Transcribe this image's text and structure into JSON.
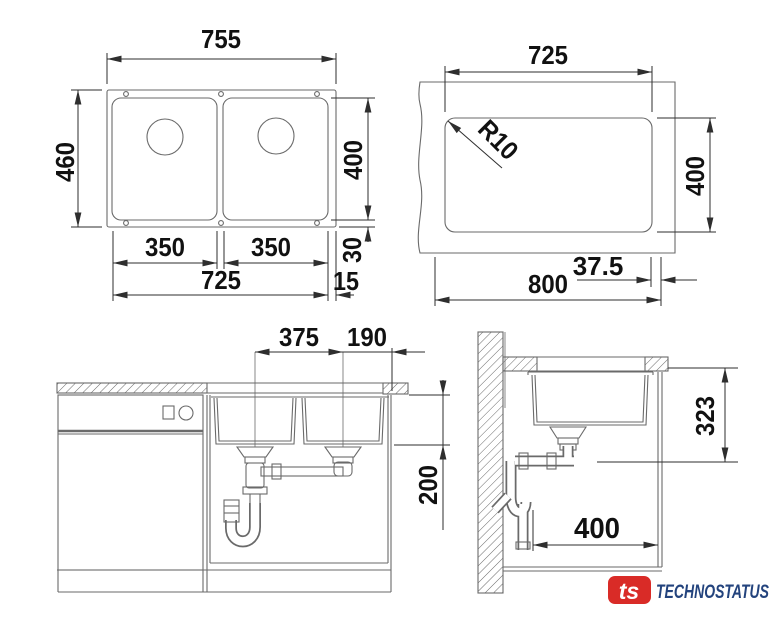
{
  "drawing": {
    "plan": {
      "overall_width": "755",
      "overall_depth": "460",
      "bowl_depth": "400",
      "rear_gap": "30",
      "side_gap": "15",
      "bowl_width_left": "350",
      "bowl_width_right": "350",
      "bowls_span": "725"
    },
    "cutout": {
      "cutout_width": "725",
      "corner_radius": "R10",
      "cutout_depth": "400",
      "edge_margin": "37.5",
      "min_width": "800"
    },
    "front_section": {
      "drain_spacing": "375",
      "drain_to_edge": "190",
      "depth_below_top": "200"
    },
    "side_section": {
      "installation_depth": "323",
      "drain_offset": "400"
    }
  },
  "branding": {
    "logo_monogram": "ts",
    "brand_name": "TECHNOSTATUS",
    "logo_bg_color": "#d92b27",
    "brand_text_color": "#23437d"
  },
  "colors": {
    "background": "#ffffff",
    "geometry_line": "#6a6a6a",
    "dimension_line": "#2e2e2e",
    "text": "#111111"
  }
}
